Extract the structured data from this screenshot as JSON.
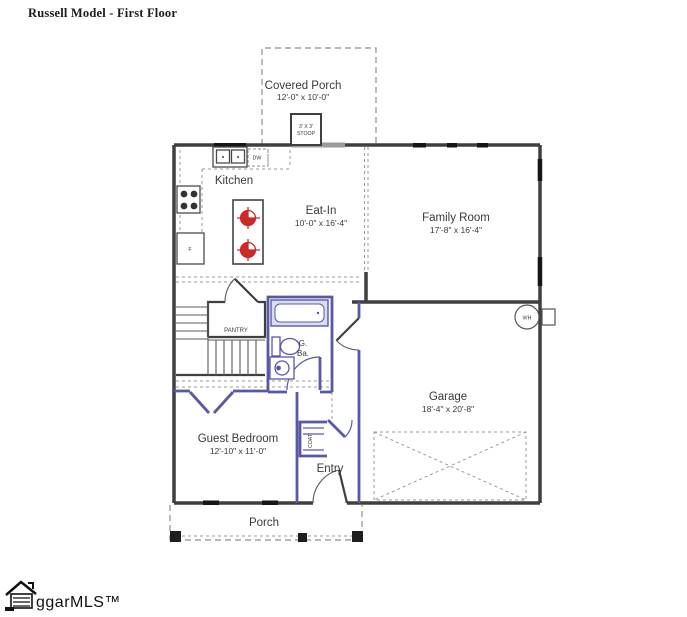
{
  "title": "Russell Model - First Floor",
  "rooms": {
    "covered_porch": {
      "name": "Covered Porch",
      "dims": "12'-0\" x 10'-0\""
    },
    "stoop": {
      "line1": "3' X 3'",
      "line2": "STOOP"
    },
    "kitchen": {
      "name": "Kitchen"
    },
    "eat_in": {
      "name": "Eat-In",
      "dims": "10'-0\" x 16'-4\""
    },
    "family_room": {
      "name": "Family Room",
      "dims": "17'-8\" x 16'-4\""
    },
    "pantry": {
      "name": "PANTRY"
    },
    "guest_bath": {
      "line1": "G.",
      "line2": "Ba."
    },
    "garage": {
      "name": "Garage",
      "dims": "18'-4\" x 20'-8\""
    },
    "guest_bedroom": {
      "name": "Guest Bedroom",
      "dims": "12'-10\" x 11'-0\""
    },
    "coat_closet": {
      "name": "COAT"
    },
    "entry": {
      "name": "Entry"
    },
    "porch": {
      "name": "Porch"
    }
  },
  "fixtures": {
    "dishwasher": "DW",
    "refrigerator": "F",
    "water_heater": "WH"
  },
  "footer": {
    "logo_text": "ggarMLS™"
  },
  "colors": {
    "wall": "#3f3f3f",
    "blue_wall": "#5858a8",
    "red_symbol": "#cc2a2a",
    "dashed_line": "#8f8f8f",
    "label_text": "#3a3a3a"
  }
}
